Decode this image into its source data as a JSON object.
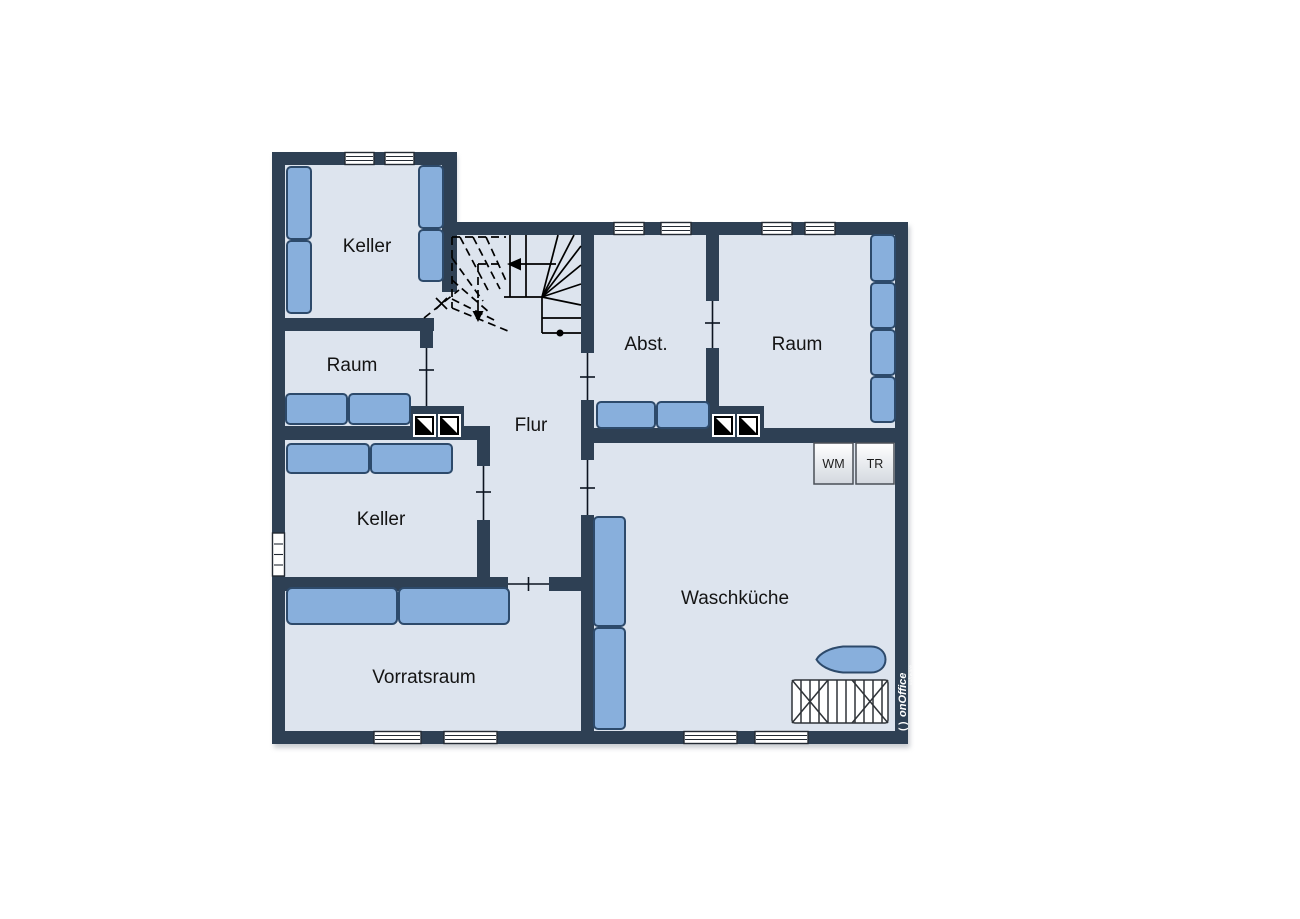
{
  "floorplan": {
    "rooms": {
      "keller_nw": {
        "label": "Keller"
      },
      "raum_w": {
        "label": "Raum"
      },
      "abst": {
        "label": "Abst."
      },
      "raum_e": {
        "label": "Raum"
      },
      "flur": {
        "label": "Flur"
      },
      "keller_w": {
        "label": "Keller"
      },
      "waschkueche": {
        "label": "Waschküche"
      },
      "vorratsraum": {
        "label": "Vorratsraum"
      }
    },
    "appliances": {
      "washing_machine": {
        "label": "WM"
      },
      "dryer": {
        "label": "TR"
      }
    },
    "branding": {
      "mark": "( )",
      "brand": "onOffice",
      "sub": "software"
    },
    "colors": {
      "wall": "#2e4054",
      "floor": "#dde4ee",
      "furniture": "#88afdc",
      "furniture_border": "#2d4a6b",
      "window": "#ffffff",
      "stair_line": "#000000",
      "background": "#ffffff"
    }
  }
}
